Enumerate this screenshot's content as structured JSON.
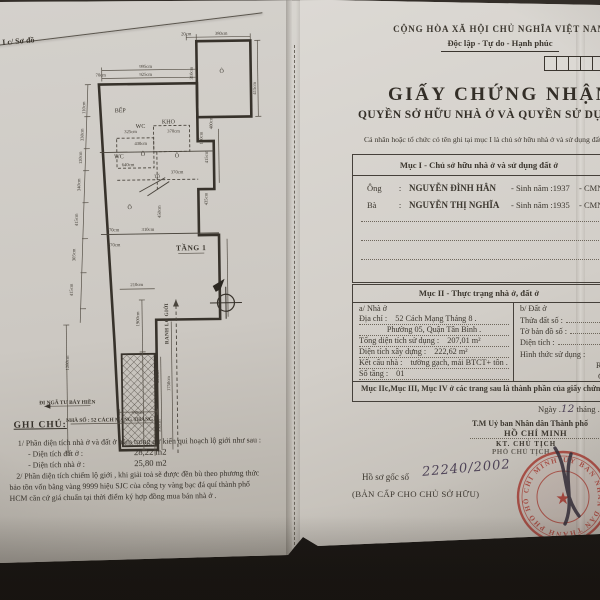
{
  "colors": {
    "stamp": "#a8453c",
    "ink": "#3c372f",
    "handwriting": "#4f4458",
    "paper": "#cfccc6",
    "backdrop": "#29241f"
  },
  "left_page": {
    "corner_label": "I c/ Sơ đồ",
    "plan": {
      "labels": [
        {
          "t": "20cm",
          "x": 181,
          "y": 24
        },
        {
          "t": "380cm",
          "x": 216,
          "y": 24
        },
        {
          "t": "310cm",
          "x": 187,
          "y": 62,
          "r": -90
        },
        {
          "t": "415cm",
          "x": 250,
          "y": 78,
          "r": -90
        },
        {
          "t": "995cm",
          "x": 140,
          "y": 56
        },
        {
          "t": "925cm",
          "x": 140,
          "y": 64
        },
        {
          "t": "70cm",
          "x": 95,
          "y": 64
        },
        {
          "t": "110cm",
          "x": 79,
          "y": 95,
          "r": -90
        },
        {
          "t": "330cm",
          "x": 77,
          "y": 122,
          "r": -90
        },
        {
          "t": "120cm",
          "x": 75,
          "y": 145,
          "r": -90
        },
        {
          "t": "340cm",
          "x": 73,
          "y": 172,
          "r": -90
        },
        {
          "t": "415cm",
          "x": 70,
          "y": 207,
          "r": -90
        },
        {
          "t": "305cm",
          "x": 67,
          "y": 242,
          "r": -90
        },
        {
          "t": "415cm",
          "x": 64,
          "y": 277,
          "r": -90
        },
        {
          "t": "1280cm",
          "x": 59,
          "y": 350,
          "r": -90
        },
        {
          "t": "400cm",
          "x": 206,
          "y": 112,
          "r": -90
        },
        {
          "t": "325cm",
          "x": 124,
          "y": 121
        },
        {
          "t": "370cm",
          "x": 167,
          "y": 121
        },
        {
          "t": "430cm",
          "x": 134,
          "y": 133
        },
        {
          "t": "130cm",
          "x": 196,
          "y": 127,
          "r": -90
        },
        {
          "t": "640cm",
          "x": 121,
          "y": 154
        },
        {
          "t": "370cm",
          "x": 170,
          "y": 162
        },
        {
          "t": "TỔ",
          "x": 150,
          "y": 166
        },
        {
          "t": "415cm",
          "x": 201,
          "y": 146,
          "r": -90
        },
        {
          "t": "435cm",
          "x": 200,
          "y": 188,
          "r": -90
        },
        {
          "t": "450cm",
          "x": 153,
          "y": 200,
          "r": -90
        },
        {
          "t": "370cm",
          "x": 105,
          "y": 219
        },
        {
          "t": "310cm",
          "x": 140,
          "y": 219
        },
        {
          "t": "370cm",
          "x": 106,
          "y": 234
        },
        {
          "t": "210cm",
          "x": 128,
          "y": 274
        },
        {
          "t": "1900cm",
          "x": 130,
          "y": 307,
          "r": -90
        },
        {
          "t": "595cm",
          "x": 149,
          "y": 365,
          "r": -90
        },
        {
          "t": "1750cm",
          "x": 160,
          "y": 372,
          "r": -90
        },
        {
          "t": "335cm",
          "x": 127,
          "y": 402
        },
        {
          "t": "950cm",
          "x": 150,
          "y": 414,
          "r": -90
        },
        {
          "t": "Ô",
          "x": 216,
          "y": 62,
          "c": "room"
        },
        {
          "t": "BẾP",
          "x": 114,
          "y": 100,
          "c": "room"
        },
        {
          "t": "WC",
          "x": 134,
          "y": 116,
          "c": "room"
        },
        {
          "t": "KHO",
          "x": 162,
          "y": 112,
          "c": "room"
        },
        {
          "t": "WC",
          "x": 112,
          "y": 146,
          "c": "room"
        },
        {
          "t": "Ô",
          "x": 136,
          "y": 144,
          "c": "room"
        },
        {
          "t": "Ô",
          "x": 170,
          "y": 146,
          "c": "room"
        },
        {
          "t": "Ô",
          "x": 122,
          "y": 197,
          "c": "room"
        },
        {
          "t": "TẦNG 1",
          "x": 183,
          "y": 239,
          "c": "big"
        },
        {
          "t": "RANH LỘ GIỚI",
          "x": 159,
          "y": 312,
          "r": -90,
          "c": "bnd"
        },
        {
          "t": "ĐI NGÃ TƯ BẢY HIỀN",
          "x": 57,
          "y": 391,
          "c": "addr"
        },
        {
          "t": "NHÀ SỐ : 52 CÁCH MẠNG THÁNG 8",
          "x": 101,
          "y": 409,
          "c": "addr"
        }
      ]
    },
    "notes": {
      "title": "GHI CHÚ:",
      "line1": "1/ Phần diện tích nhà ở và đất ở nằm trong dự kiến qui hoạch lộ giới  như sau :",
      "item1_label": "- Diện tích đất ở :",
      "item1_value": "28,22  m2",
      "item2_label": "- Diện tích nhà ở :",
      "item2_value": "25,80  m2",
      "line2a": "2/ Phần diện tích chiếm lộ giới , khi giải toả sẽ được đền bù theo  phương thức",
      "line2b": "bảo tồn vốn bằng vàng 9999 hiệu SJC của công ty vàng bạc đá quí thành phố",
      "line2c": "HCM căn cứ giá chuẩn tại thời điểm ký hợp đồng mua  bán nhà ở  ."
    }
  },
  "right_page": {
    "header": {
      "country": "CỘNG HÒA XÃ HỘI CHỦ NGHĨA VIỆT NAM",
      "motto": "Độc lập - Tự do - Hạnh phúc"
    },
    "title": "GIẤY CHỨNG NHẬN",
    "subtitle": "QUYỀN SỞ HỮU NHÀ Ở VÀ QUYỀN SỬ DỤNG ĐẤT Ở",
    "intro": "Cá nhân hoặc tổ chức có tên ghi tại mục I là chủ sở hữu nhà ở và sử dụng đất ở",
    "section1": {
      "heading": "Mục I - Chủ sở hữu nhà ở và sử dụng đất ở",
      "rows": [
        {
          "pre": "Ông",
          "colon": ":",
          "name": "NGUYỄN ĐÌNH HÂN",
          "birth": "- Sinh năm :1937",
          "idno": "- CMND"
        },
        {
          "pre": "Bà",
          "colon": ":",
          "name": "NGUYỄN THỊ NGHĨA",
          "birth": "- Sinh năm :1935",
          "idno": "- CMND"
        }
      ]
    },
    "section2": {
      "heading": "Mục II - Thực trạng nhà ở, đất ở",
      "house": {
        "heading": "a/ Nhà ở",
        "address_label": "Địa chỉ :",
        "address_value": "52  Cách Mạng Tháng 8 .",
        "address_line2": "Phường 05, Quận Tân Bình .",
        "total_label": "Tổng diện tích sử dụng :",
        "total_value": "207,01  m²",
        "built_label": "Diện tích xây dựng :",
        "built_value": "222,62  m²",
        "structure_label": "Kết cấu nhà :",
        "structure_value": "tường gạch, mái BTCT+ tôn .",
        "floors_label": "Số tầng :",
        "floors_value": "01"
      },
      "land": {
        "heading": "b/ Đất ở",
        "parcel_label": "Thửa đất số :",
        "map_label": "Tờ bản đồ số :",
        "area_label": "Diện tích :",
        "use_label": "Hình thức sử dụng :",
        "private_label": "Riêng :",
        "shared_label": "Chung :"
      },
      "footer": "Mục IIc,Mục III, Mục IV ở các trang sau là thành phần của giấy chứng nhận"
    },
    "signature": {
      "date_label": "Ngày .",
      "date_day": "12",
      "month_label": " tháng .",
      "date_month": "1",
      "authority_line": "T.M Uỷ ban Nhân dân Thành phố",
      "city": "HỒ CHÍ MINH",
      "kt": "KT. CHỦ TỊCH",
      "deputy": "PHÓ CHỦ TỊCH",
      "dossier_label": "Hồ sơ gốc số",
      "dossier_value": "22240/2002",
      "copy_note": "(BẢN CẤP CHO CHỦ SỞ HỮU)"
    },
    "stamp": {
      "ring_text": "ỦY BAN NHÂN DÂN THÀNH PHỐ HỒ CHÍ MINH  •  ỦY BAN NHÂN DÂN",
      "star": "★"
    }
  }
}
